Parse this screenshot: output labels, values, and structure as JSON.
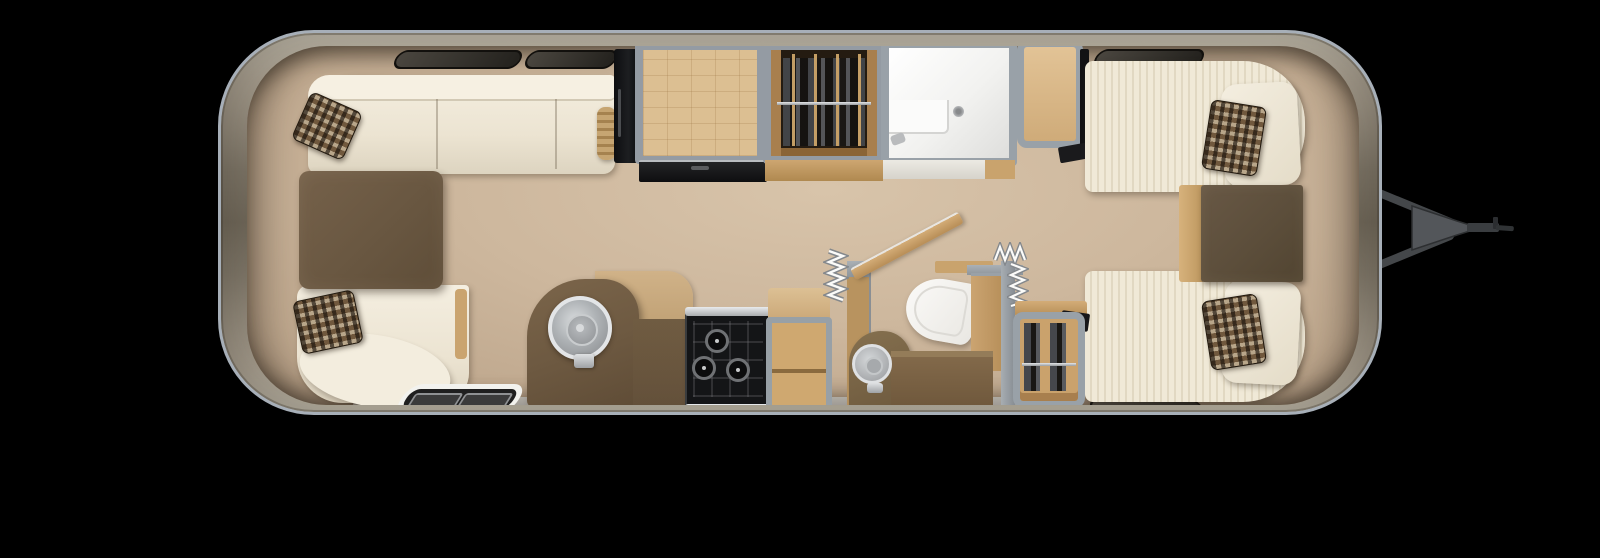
{
  "scene": {
    "title": "Airstream-style travel trailer floor plan (top-down 3D render)",
    "background_color": "#000000",
    "view": "overhead interior cutaway, hitch pointing right"
  },
  "trailer": {
    "label": "Travel trailer floor plan",
    "shell": {
      "label": "Aluminum body shell",
      "outline_color": "#a7afb8",
      "body_color": "#8d8577"
    },
    "floor": {
      "label": "Interior floor",
      "color": "#cdb79d",
      "walkway_color": "#9b9894"
    },
    "windows": {
      "label": "Tinted windows",
      "color": "#2b2823",
      "positions": [
        "front-left curved",
        "front-right curved",
        "rear-left curved",
        "rear-right curved",
        "left-side",
        "right-side",
        "top-wall x3",
        "bottom-wall x1"
      ]
    }
  },
  "rooms": {
    "lounge": {
      "label": "Front lounge",
      "sofa_label": "Wrap-around sofa",
      "table_label": "Lounge table",
      "pillow_label": "Mosaic accent pillow",
      "bolster_label": "Bolster pillow",
      "entry_label": "Entry step mat",
      "sofa_color": "#efe8d7",
      "table_color": "#6b583e"
    },
    "kitchen": {
      "label": "Galley kitchen",
      "sink_label": "Round stainless sink",
      "faucet_label": "Sink faucet",
      "cooktop_label": "Three-burner cooktop",
      "counter_label": "Kitchen counter",
      "shelf_label": "Open shelf cabinet",
      "fridge_label": "Refrigerator",
      "dresser_label": "Overhead galley cabinet",
      "credenza_label": "Flat-screen TV / credenza",
      "counter_color": "#6f5b41",
      "cooktop_color": "#141517"
    },
    "closet": {
      "label": "Wardrobe closet",
      "contents_label": "Hanging clothes on wood hangers",
      "rod_label": "Closet rod"
    },
    "bathroom": {
      "label": "Bathroom",
      "shower_label": "Shower stall",
      "drain_label": "Shower drain",
      "toilet_label": "Toilet",
      "vanity_label": "Vanity with round sink",
      "door_label": "Open pocket door",
      "accordion_label": "Accordion privacy doors",
      "shower_color": "#f2f2f0"
    },
    "bedroom": {
      "label": "Rear twin bedroom",
      "bed_top_label": "Twin bed (curb side)",
      "bed_bottom_label": "Twin bed (street side)",
      "nightstand_label": "Nightstand",
      "wardrobe_label": "Foot-of-bed wardrobe",
      "pillow_label": "Mosaic accent pillow",
      "bed_color": "#ece4d0",
      "nightstand_color": "#5c4e3b"
    }
  },
  "hitch": {
    "label": "Tow hitch and A-frame tongue",
    "color": "#4a4d50"
  },
  "palette": {
    "cream": "#efe8d7",
    "walnut": "#6b583e",
    "light_wood": "#cfa870",
    "gray_wall": "#99a1a8",
    "dark_glass": "#2b2823",
    "stainless": "#c9ccce"
  }
}
